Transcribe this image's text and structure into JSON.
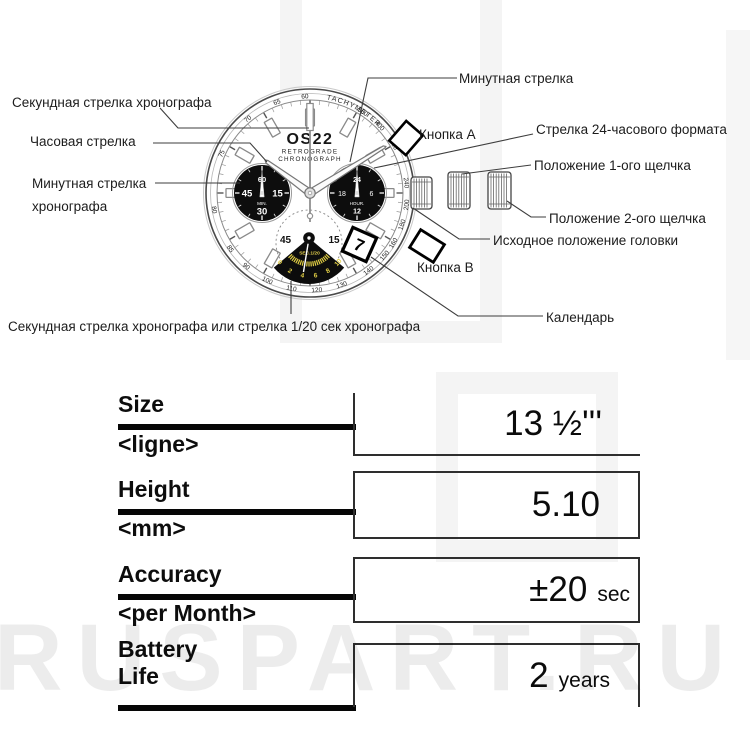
{
  "watermark": {
    "text": "RUSPART.RU"
  },
  "diagram": {
    "callouts": {
      "chrono_seconds": "Секундная стрелка хронографа",
      "hour_hand": "Часовая стрелка",
      "chrono_minute_1": "Минутная стрелка",
      "chrono_minute_2": "хронографа",
      "minute_hand": "Минутная стрелка",
      "button_a": "Кнопка A",
      "hand_24h": "Стрелка 24-часового формата",
      "click_pos_1": "Положение 1-ого щелчка",
      "click_pos_2": "Положение 2-ого щелчка",
      "crown_home": "Исходное положение головки",
      "button_b": "Кнопка B",
      "calendar": "Календарь",
      "chrono_sec_or_120": "Секундная стрелка хронографа или стрелка 1/20 сек хронографа"
    },
    "dial": {
      "brand": "OS22",
      "line1": "RETROGRADE",
      "line2": "CHRONOGRAPH",
      "tachymeter_label": "TACHYMETER",
      "tachymeter_numbers": [
        {
          "a": -3,
          "t": "60"
        },
        {
          "a": 33,
          "t": "500"
        },
        {
          "a": 46,
          "t": "400"
        },
        {
          "a": 60,
          "t": "300"
        },
        {
          "a": 84,
          "t": "240"
        },
        {
          "a": 97,
          "t": "200"
        },
        {
          "a": 109,
          "t": "180"
        },
        {
          "a": 121,
          "t": "160"
        },
        {
          "a": 130,
          "t": "150"
        },
        {
          "a": 143,
          "t": "140"
        },
        {
          "a": 161,
          "t": "130"
        },
        {
          "a": 176,
          "t": "120"
        },
        {
          "a": 191,
          "t": "110"
        },
        {
          "a": 206,
          "t": "100"
        },
        {
          "a": 221,
          "t": "90"
        },
        {
          "a": 235,
          "t": "85"
        },
        {
          "a": 260,
          "t": "80"
        },
        {
          "a": 294,
          "t": "75"
        },
        {
          "a": 320,
          "t": "70"
        },
        {
          "a": 340,
          "t": "65"
        }
      ],
      "subdial_min": {
        "top": "60",
        "left": "45",
        "right": "15",
        "label": "MIN.",
        "bottom": "30"
      },
      "subdial_hour": {
        "top": "24",
        "left": "18",
        "right": "6",
        "label": "HOUR.",
        "bottom": "12"
      },
      "subdial_sec": {
        "left": "45",
        "right": "15",
        "label": "SEC.1/20",
        "numbers": [
          "0",
          "2",
          "4",
          "6",
          "8",
          "10"
        ]
      },
      "date": "7",
      "accent_yellow": "#e2cf45"
    }
  },
  "spec_table": {
    "rows": [
      {
        "label": "Size",
        "sub": "<ligne>",
        "value": "13 ½'''",
        "unit": ""
      },
      {
        "label": "Height",
        "sub": "<mm>",
        "value": "5.10",
        "unit": ""
      },
      {
        "label": "Accuracy",
        "sub": "<per Month>",
        "value": "±20",
        "unit": "sec"
      },
      {
        "label": "Battery",
        "sub": "Life",
        "value": "2",
        "unit": "years"
      }
    ]
  }
}
